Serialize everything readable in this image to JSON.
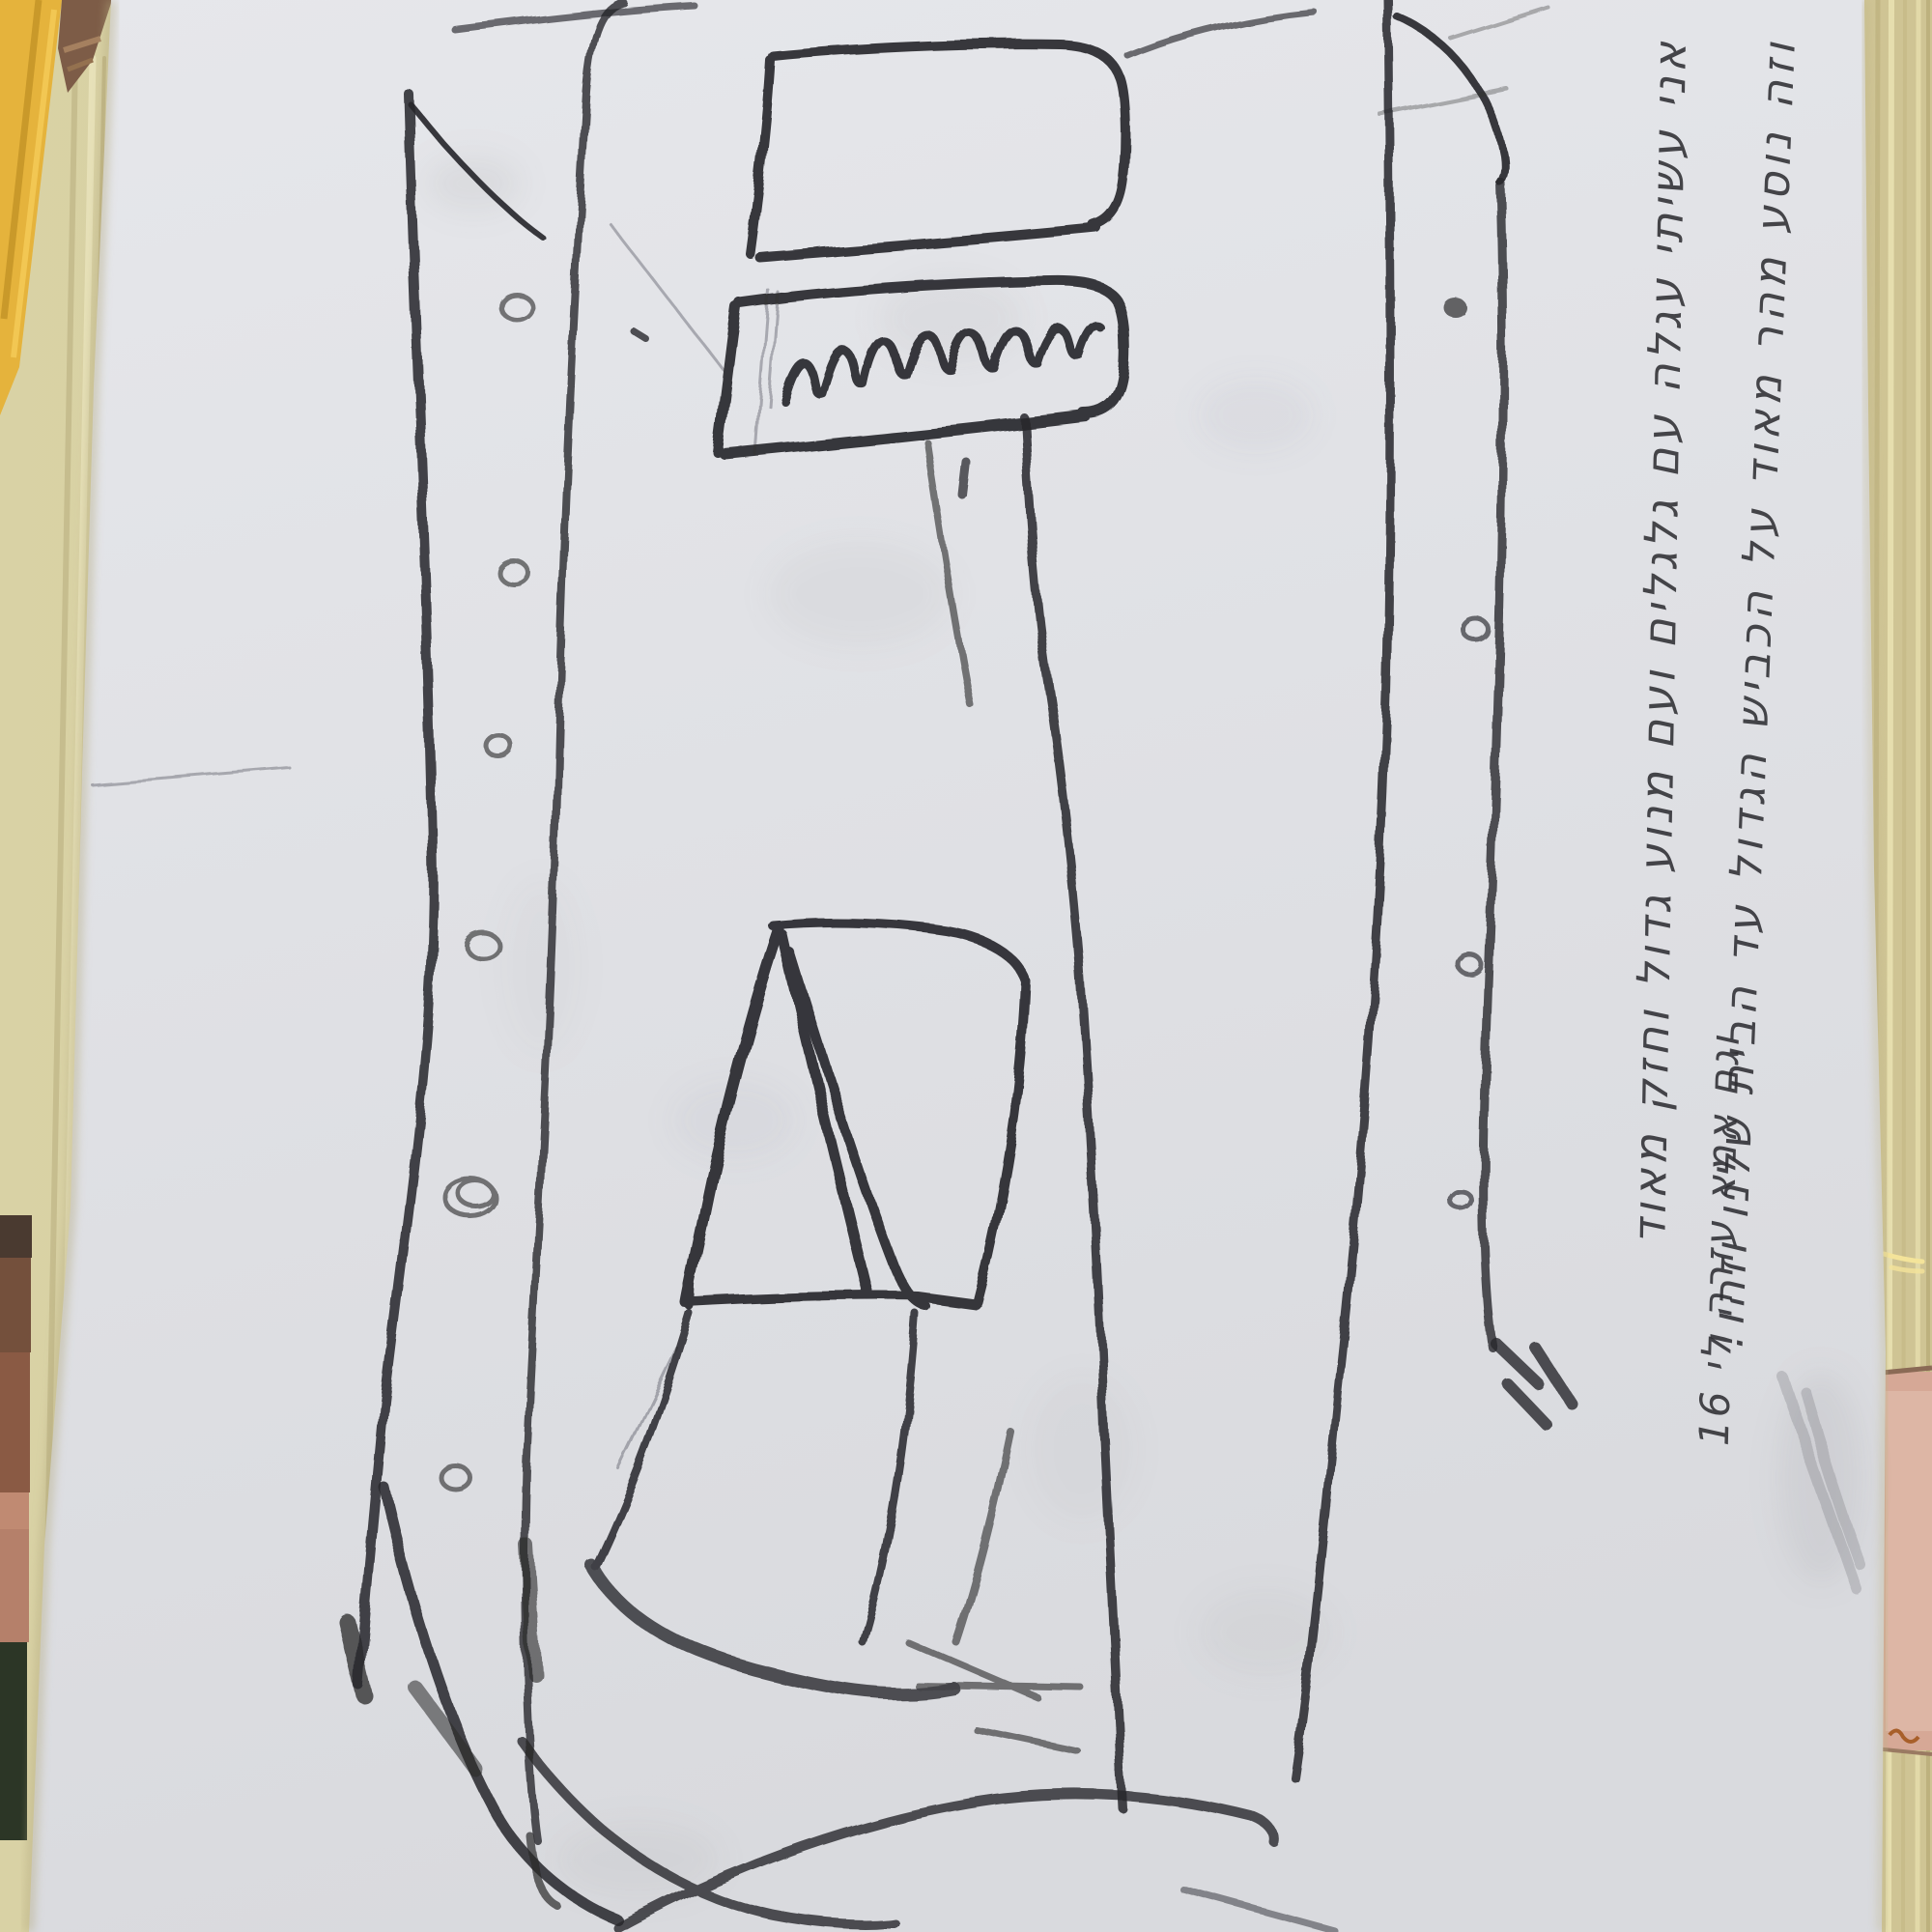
{
  "scene": {
    "type": "photograph",
    "description": "Hand-drawn charcoal sketch on a white sheet of paper lying on a pale wooden table, photographed from above",
    "paper_color": "#e2e3e7",
    "charcoal_color": "#26262a",
    "table_wood_color": "#d5cb9e",
    "yellow_object_color": "#e5b33c",
    "brown_object_color": "#83604a",
    "pink_object_color": "#d6a896",
    "photo_fragment_colors": [
      "#4a3a30",
      "#74503c",
      "#8a5a44",
      "#c08a72",
      "#2c3626"
    ]
  },
  "sketch": {
    "medium": "charcoal / soft pencil",
    "elements": [
      "tall outer frame with double side rails",
      "six small hand-drawn circles (rivets) along the left rail",
      "four small circles along the right rail, top one filled dark",
      "two stacked rounded rectangles at the top (button and label box)",
      "illegible cursive scribble inside the lower rounded rectangle",
      "long curved neck line running down the right middle",
      "large rounded square with a fan of diagonal curves inside",
      "tilted quadrilateral below the square",
      "sweeping overlapping curves across the bottom"
    ]
  },
  "handwriting": {
    "script": "Hebrew cursive, handwritten in charcoal",
    "orientation": "rotated 90° — runs top-to-bottom along the right paper edge",
    "legibility": "low — approximate transcription",
    "ends_with": "!",
    "contains_number": "16",
    "lines": [
      {
        "id": 1,
        "text": "אני עשיתי עגלה עם גלגלים ועם מנוע גדול וחזק מאוד"
      },
      {
        "id": 2,
        "text": "וזה נוסע מהר מאוד על הכביש הגדול עד הבית שלנו וזהו!"
      },
      {
        "id": 3,
        "text": "וגם אמא עזרה לי 16"
      }
    ],
    "label_scribble": "illegible cursive scribble"
  }
}
